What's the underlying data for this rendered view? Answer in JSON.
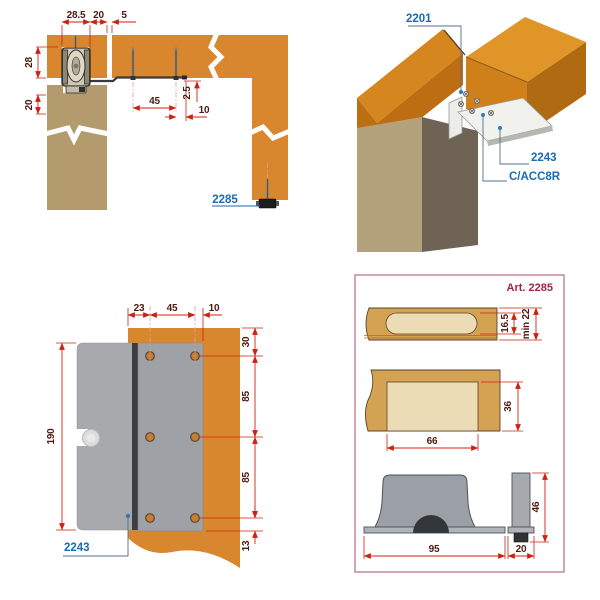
{
  "top_left": {
    "dims": {
      "roller_width": "28.5",
      "offset": "20",
      "gap": "5",
      "roller_height": "28",
      "panel_reveal": "20",
      "screw_spacing": "45",
      "plate_offset": "2.5",
      "edge_distance": "10"
    },
    "part_label": "2285"
  },
  "top_right": {
    "labels": {
      "track": "2201",
      "bracket": "2243",
      "accessory": "C/ACC8R"
    }
  },
  "bottom_left": {
    "dims": {
      "left_margin": "23",
      "hole_spacing_h": "45",
      "right_margin": "10",
      "top_margin": "30",
      "hole_spacing_v1": "85",
      "hole_spacing_v2": "85",
      "bottom_margin": "13",
      "plate_height": "190"
    },
    "part_label": "2243"
  },
  "bottom_right": {
    "title": "Art. 2285",
    "dims": {
      "slot_depth": "16.5",
      "min_thickness": "min 22",
      "pocket_width": "66",
      "pocket_depth": "36",
      "base_width": "95",
      "body_height": "46",
      "base_depth": "20"
    }
  },
  "colors": {
    "panel_orange": "#d8872e",
    "panel_tan": "#b49b6e",
    "label_blue": "#1a6ab5",
    "box_crimson": "#a22345",
    "dimension_red": "#cc2211",
    "wood_gold": "#d3a353",
    "wood_pocket": "#ecdcb5",
    "metal_gray": "#a0a3a8"
  }
}
